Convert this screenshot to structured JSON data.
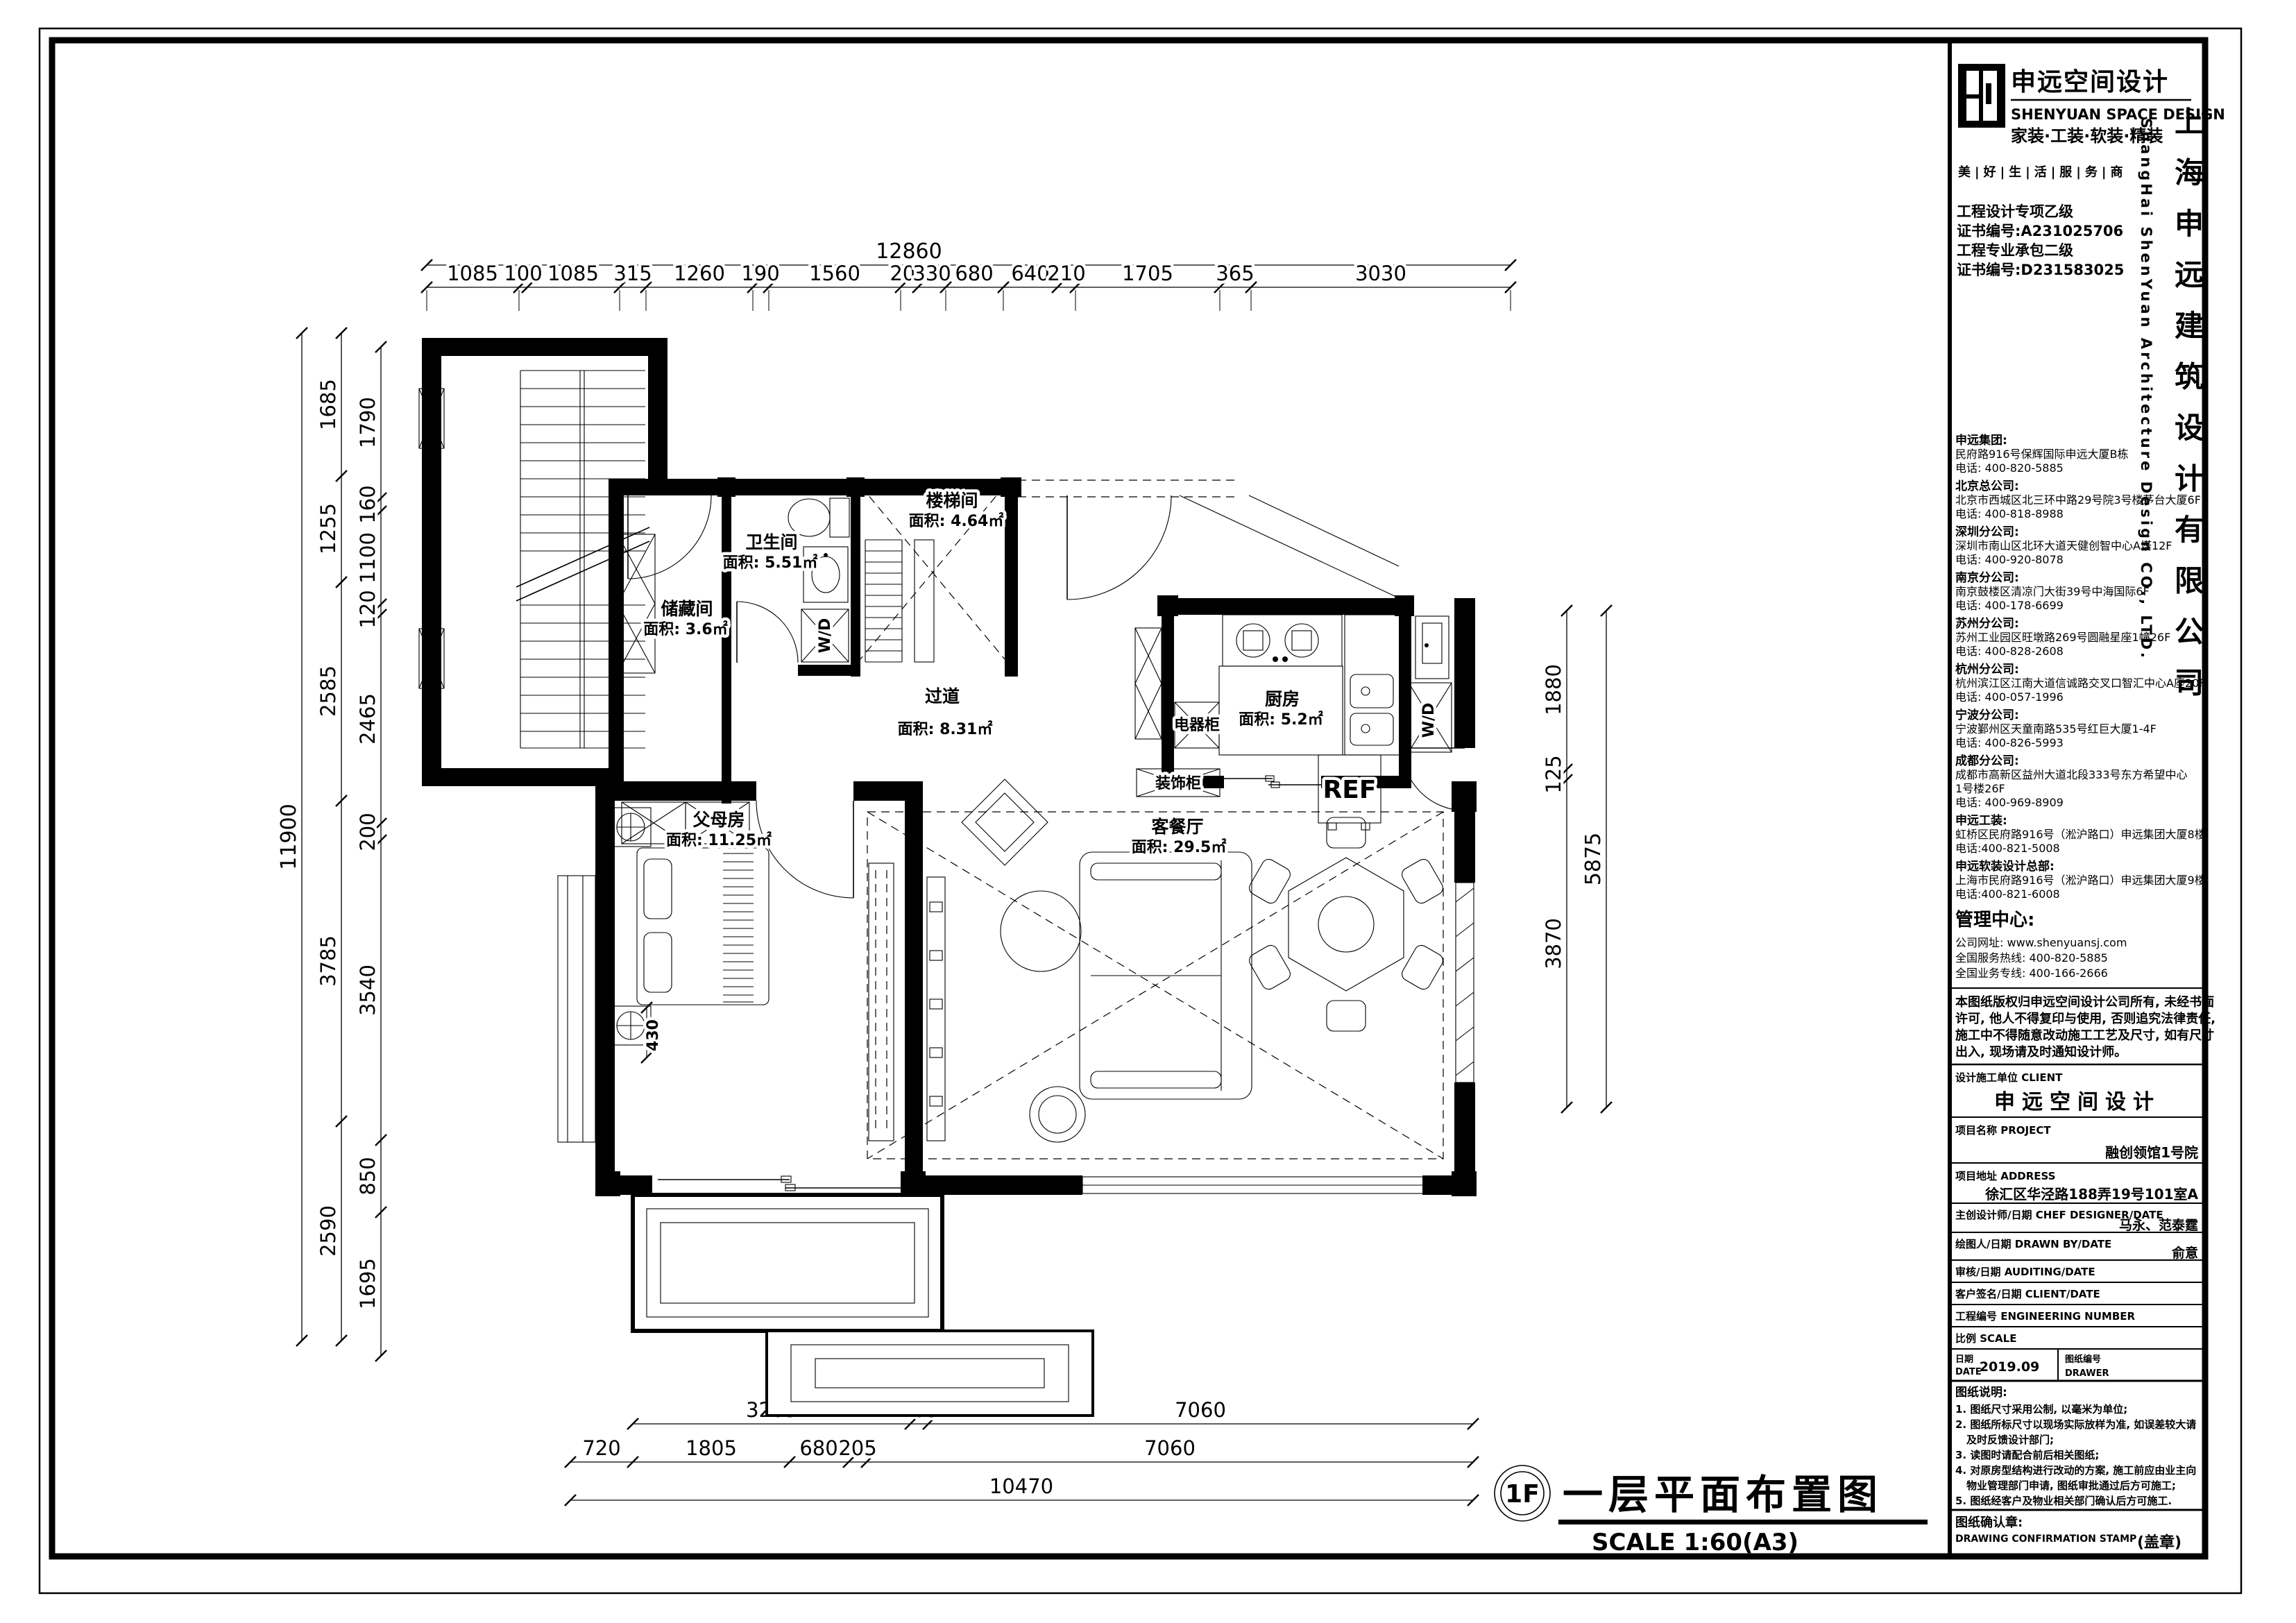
{
  "sheet": {
    "floor_tag": "1F",
    "drawing_title": "一层平面布置图",
    "drawing_scale": "SCALE 1:60(A3)"
  },
  "plan": {
    "rooms": {
      "storage": {
        "name": "储藏间",
        "area": "面积: 3.6㎡"
      },
      "bathroom": {
        "name": "卫生间",
        "area": "面积: 5.51㎡"
      },
      "stairhall": {
        "name": "楼梯间",
        "area": "面积: 4.64㎡"
      },
      "hallway": {
        "name": "过道",
        "area": "面积: 8.31㎡"
      },
      "kitchen": {
        "name": "厨房",
        "area": "面积: 5.2㎡"
      },
      "living": {
        "name": "客餐厅",
        "area": "面积: 29.5㎡"
      },
      "parents": {
        "name": "父母房",
        "area": "面积: 11.25㎡"
      }
    },
    "fixtures": {
      "fridge": "REF",
      "washer_dryer": "W/D",
      "appliance_cabinet": "电器柜",
      "decor_cabinet": "装饰柜",
      "bed_offset": "430"
    }
  },
  "dims": {
    "top": {
      "overall": "12860",
      "segments": [
        "1085",
        "100",
        "1085",
        "315",
        "1260",
        "190",
        "1560",
        "205",
        "330",
        "680",
        "640",
        "210",
        "1705",
        "365",
        "3030"
      ]
    },
    "left": {
      "overall": "11900",
      "mid": [
        "1685",
        "1255",
        "2585",
        "3785",
        "2590"
      ],
      "inner": [
        "1790",
        "160",
        "1100",
        "120",
        "2465",
        "200",
        "3540",
        "850",
        "1695"
      ]
    },
    "right": {
      "overall": "5875",
      "inner": [
        "1880",
        "125",
        "3870"
      ]
    },
    "bottom": {
      "row1": [
        "3205",
        "205",
        "7060"
      ],
      "row2": [
        "720",
        "1805",
        "680",
        "205",
        "7060"
      ],
      "overall": "10470"
    }
  },
  "titleblock": {
    "logo": {
      "cn": "申远空间设计",
      "en": "SHENYUAN SPACE DESIGN",
      "services": "家装·工装·软装·精装",
      "slogan": "美|好|生|活|服|务|商"
    },
    "company_cn_vertical": "上海申远建筑设计有限公司",
    "company_en_vertical": "ShangHai ShenYuan Architecture Design CO., LTD.",
    "certs": [
      "工程设计专项乙级",
      "证书编号:A231025706",
      "工程专业承包二级",
      "证书编号:D231583025"
    ],
    "offices": [
      {
        "title": "申远集团:",
        "lines": [
          "民府路916号保辉国际申远大厦B栋",
          "电话: 400-820-5885"
        ]
      },
      {
        "title": "北京总公司:",
        "lines": [
          "北京市西城区北三环中路29号院3号楼茅台大厦6F",
          "电话: 400-818-8988"
        ]
      },
      {
        "title": "深圳分公司:",
        "lines": [
          "深圳市南山区北环大道天健创智中心A塔12F",
          "电话: 400-920-8078"
        ]
      },
      {
        "title": "南京分公司:",
        "lines": [
          "南京鼓楼区清凉门大街39号中海国际6F",
          "电话: 400-178-6699"
        ]
      },
      {
        "title": "苏州分公司:",
        "lines": [
          "苏州工业园区旺墩路269号圆融星座1幢26F",
          "电话: 400-828-2608"
        ]
      },
      {
        "title": "杭州分公司:",
        "lines": [
          "杭州滨江区江南大道信诚路交叉口智汇中心A座20F",
          "电话: 400-057-1996"
        ]
      },
      {
        "title": "宁波分公司:",
        "lines": [
          "宁波鄞州区天童南路535号红巨大厦1-4F",
          "电话: 400-826-5993"
        ]
      },
      {
        "title": "成都分公司:",
        "lines": [
          "成都市高新区益州大道北段333号东方希望中心",
          "1号楼26F",
          "电话: 400-969-8909"
        ]
      },
      {
        "title": "申远工装:",
        "lines": [
          "虹桥区民府路916号（淞沪路口）申远集团大厦8楼",
          "电话:400-821-5008"
        ]
      },
      {
        "title": "申远软装设计总部:",
        "lines": [
          "上海市民府路916号（淞沪路口）申远集团大厦9楼",
          "电话:400-821-6008"
        ]
      }
    ],
    "management": {
      "title": "管理中心:",
      "lines": [
        "公司网址: www.shenyuansj.com",
        "全国服务热线: 400-820-5885",
        "全国业务专线: 400-166-2666"
      ]
    },
    "copyright": [
      "本图纸版权归申远空间设计公司所有, 未经书面",
      "许可, 他人不得复印与使用, 否则追究法律责任,",
      "施工中不得随意改动施工工艺及尺寸, 如有尺寸",
      "出入, 现场请及时通知设计师。"
    ],
    "rows": [
      {
        "label": "设计施工单位 CLIENT",
        "value": "申远空间设计"
      },
      {
        "label": "项目名称 PROJECT",
        "value": "融创领馆1号院"
      },
      {
        "label": "项目地址 ADDRESS",
        "value": "徐汇区华泾路188弄19号101室A"
      },
      {
        "label": "主创设计师/日期 CHEF DESIGNER/DATE",
        "value": "马永、范泰霆"
      },
      {
        "label": "绘图人/日期 DRAWN BY/DATE",
        "value": "俞意"
      },
      {
        "label": "审核/日期 AUDITING/DATE",
        "value": ""
      },
      {
        "label": "客户签名/日期 CLIENT/DATE",
        "value": ""
      },
      {
        "label": "工程编号 ENGINEERING NUMBER",
        "value": ""
      },
      {
        "label": "比例 SCALE",
        "value": ""
      }
    ],
    "date_row": {
      "label_cn": "日期",
      "label_en": "DATE",
      "value": "2019.09",
      "right_label_cn": "图纸编号",
      "right_label_en": "DRAWER"
    },
    "notes": {
      "title": "图纸说明:",
      "lines": [
        "1. 图纸尺寸采用公制, 以毫米为单位;",
        "2. 图纸所标尺寸以现场实际放样为准, 如误差较大请",
        "及时反馈设计部门;",
        "3. 读图时请配合前后相关图纸;",
        "4. 对原房型结构进行改动的方案, 施工前应由业主向",
        "物业管理部门申请, 图纸审批通过后方可施工;",
        "5. 图纸经客户及物业相关部门确认后方可施工."
      ]
    },
    "stamp": {
      "label_cn": "图纸确认章:",
      "label_en": "DRAWING CONFIRMATION STAMP",
      "seal": "(盖章)"
    }
  }
}
